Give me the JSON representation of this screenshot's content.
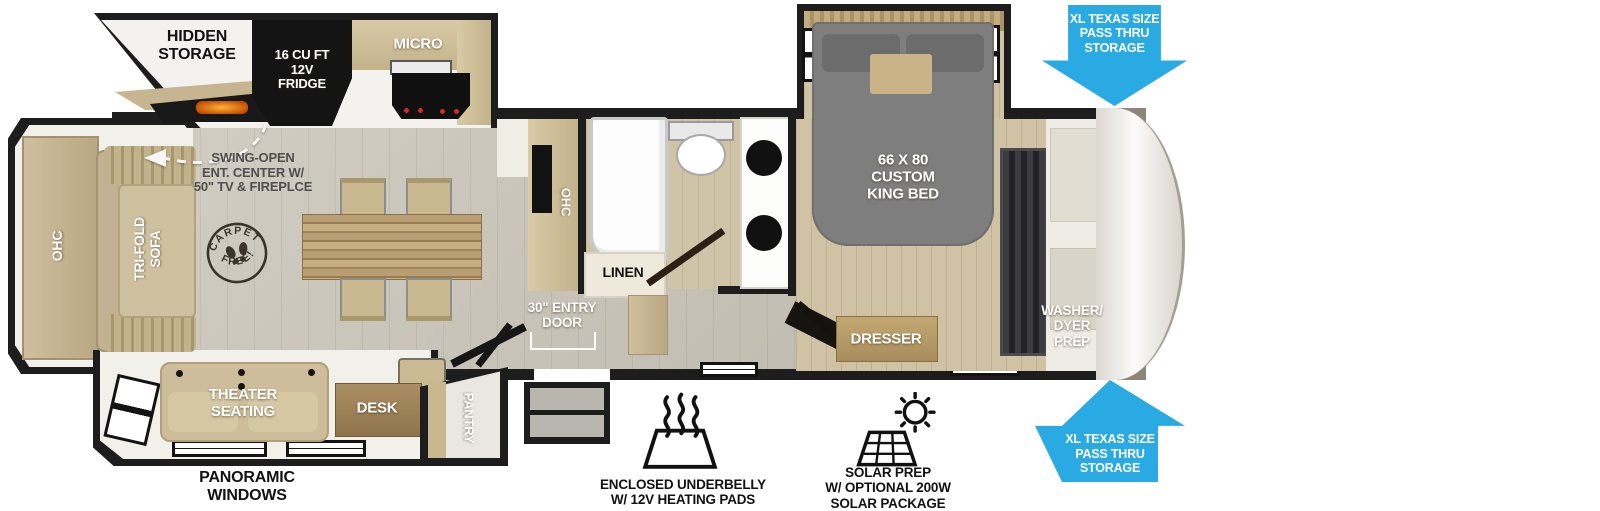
{
  "plan": {
    "kitchen": {
      "hidden_storage": "HIDDEN\nSTORAGE",
      "fridge": "16 CU FT\n12V\nFRIDGE",
      "micro": "MICRO",
      "ohc": "OHC",
      "swing_note": "SWING-OPEN\nENT. CENTER W/\n50\" TV & FIREPLCE"
    },
    "living": {
      "ohc": "OHC",
      "sofa": "TRI-FOLD\nSOFA",
      "theater": "THEATER\nSEATING",
      "desk": "DESK",
      "pantry": "PANTRY"
    },
    "stamp": {
      "top": "CARPET",
      "bottom": "FREE!"
    },
    "bath": {
      "linen": "LINEN"
    },
    "entry_door": "30\" ENTRY\nDOOR",
    "bedroom": {
      "bed": "66 X 80\nCUSTOM\nKING BED",
      "dresser": "DRESSER"
    },
    "front": {
      "washer": "WASHER/\nDYER\nPREP"
    }
  },
  "callouts": {
    "pass_thru_top": "XL TEXAS SIZE\nPASS THRU\nSTORAGE",
    "pass_thru_bottom": "XL TEXAS SIZE\nPASS THRU\nSTORAGE",
    "panoramic": "PANORAMIC\nWINDOWS",
    "underbelly": "ENCLOSED UNDERBELLY\nW/ 12V HEATING PADS",
    "solar": "SOLAR PREP\nW/ OPTIONAL 200W\nSOLAR PACKAGE"
  },
  "colors": {
    "wall": "#1d1d1d",
    "floor": "#c9c3b7",
    "wood_floor": "#d0c3a5",
    "cabinet": "#c6b58e",
    "counter": "#f0ede6",
    "bed_gray": "#7e7e7e",
    "arrow_blue": "#29aae2",
    "stamp": "#3a342c"
  },
  "icons": [
    "pass-thru-arrow-down",
    "pass-thru-arrow-up",
    "heating-pad",
    "solar-panel-sun",
    "carpet-free-stamp",
    "swing-open-arrow"
  ]
}
